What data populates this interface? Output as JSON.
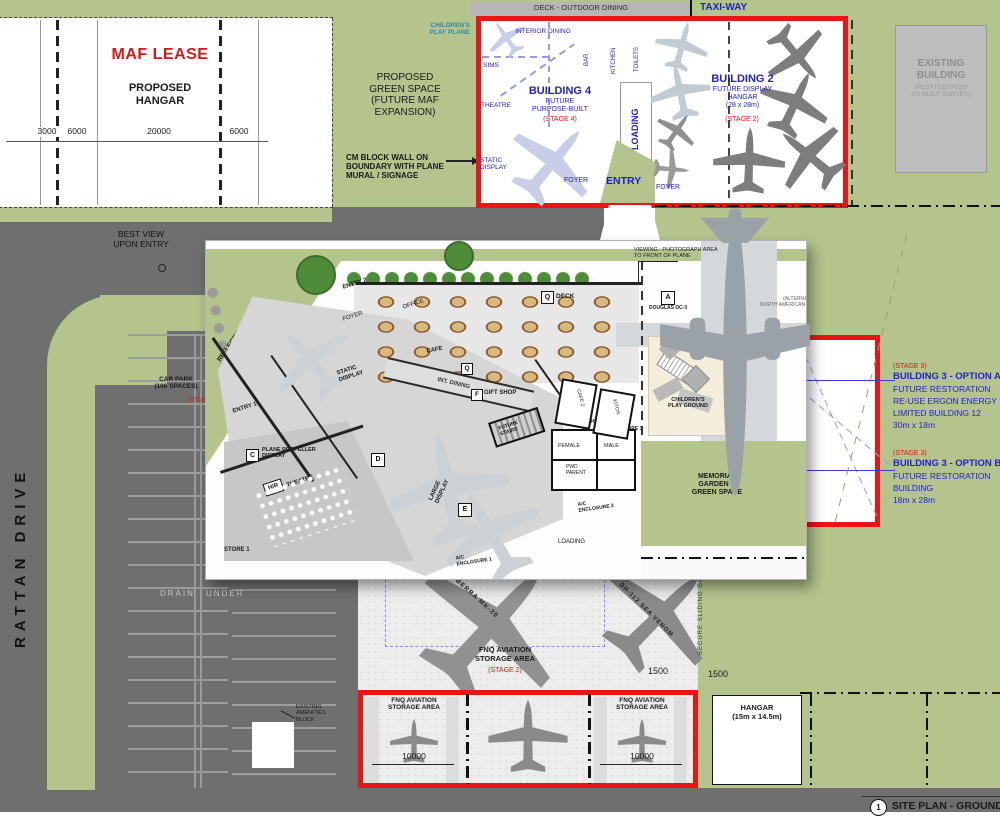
{
  "top": {
    "deck": "DECK - OUTDOOR DINING",
    "taxiway": "TAXI-WAY"
  },
  "maf": {
    "lease": "MAF LEASE",
    "hangar": "PROPOSED\nHANGAR",
    "dims": {
      "d1": "3000",
      "d2": "6000",
      "d3": "20000",
      "d4": "6000"
    }
  },
  "green_space": {
    "label": "PROPOSED\nGREEN SPACE\n(FUTURE MAF\nEXPANSION)",
    "cm_wall": "CM BLOCK WALL ON\nBOUNDARY WITH PLANE\nMURAL / SIGNAGE"
  },
  "b4": {
    "children": "CHILDREN'S\nPLAY PLANE",
    "interior": "INTERIOR DINING",
    "bar": "BAR",
    "kitchen": "KITCHEN",
    "toilets": "TOILETS",
    "sims": "SIMS",
    "theatre": "THEATRE",
    "title": "BUILDING 4",
    "sub": "FUTURE\nPURPOSE-BUILT",
    "stage": "(STAGE 4)",
    "static": "STATIC\nDISPLAY",
    "foyer": "FOYER",
    "loading": "LOADING",
    "entry": "ENTRY"
  },
  "b2": {
    "title": "BUILDING 2",
    "sub": "FUTURE DISPLAY\nHANGAR\n(28 x 28m)",
    "stage": "(STAGE 2)",
    "foyer": "FOYER"
  },
  "existing": {
    "name": "EXISTING\nBUILDING",
    "note": "(PLOTTED FROM\nAS-BUILT SURVEY)"
  },
  "west": {
    "best_view": "BEST VIEW\nUPON ENTRY",
    "street": "RATTAN DRIVE",
    "car_park": "CAR PARK\n(106 SPACES)",
    "car_park_stage": "(STAGE 1)",
    "drain_l": "DRAIN",
    "drain_r": "UNDER"
  },
  "b3": {
    "a_stage": "(STAGE 3)",
    "a_title": "BUILDING 3 - OPTION A:",
    "a_l1": "FUTURE RESTORATION",
    "a_l2": "RE-USE ERGON ENERGY",
    "a_l3": "LIMITED BUILDING 12",
    "a_l4": "30m x 18m",
    "b_stage": "(STAGE 3)",
    "b_title": "BUILDING 3 - OPTION B:",
    "b_l1": "FUTURE RESTORATION",
    "b_l2": "BUILDING",
    "b_l3": "18m x 28m"
  },
  "storage": {
    "label": "FNQ AVIATION\nSTORAGE AREA",
    "stage": "(STAGE 2)",
    "plane1": "CANBERRA  MK-20",
    "plane2": "DH-112 SEA VENOM",
    "dim_a": "1500",
    "dim_b": "1500",
    "gate": "SECURE SLIDING GATE"
  },
  "bays": {
    "label": "FNQ AVIATION\nSTORAGE AREA",
    "dim": "10000"
  },
  "hangar_lot": {
    "label": "HANGAR\n(15m x 14.5m)"
  },
  "amenities": {
    "label": "EXISTING\nAMENITIES\nBLOCK"
  },
  "titleblock": {
    "num": "1",
    "title": "SITE PLAN - GROUND LEVEL"
  },
  "inset": {
    "reflections": "REFLECTIONS\nGARDEN",
    "entry2": "ENTRY 2",
    "foyer": "FOYER",
    "office": "OFFICE",
    "q": "Q",
    "deck": "DECK",
    "cafe": "CAFE",
    "int_dining": "INT. DINING",
    "f": "F",
    "gift": "GIFT SHOP",
    "static": "STATIC\nDISPLAY",
    "entry1": "ENTRY 1",
    "c": "C",
    "prop": "PLANE PROPELLER\nDISPLAY",
    "hr": "H/R",
    "theatre": "THEATRE",
    "store1": "STORE 1",
    "d": "D",
    "e": "E",
    "large": "LARGE\nDISPLAY",
    "stairs": "FUTURE\nSTAIRS",
    "airlock": "AIR LOCK",
    "female": "FEMALE",
    "male": "MALE",
    "pwd": "PWD\nPARENT",
    "ac2": "A/C\nENCLOSURE 2",
    "ac1": "A/C\nENCLOSURE 1",
    "loading": "LOADING",
    "store3": "STORE 3",
    "cafe2": "CAFE 2",
    "kitch": "KITCH.",
    "viewing": "VIEWING : PHOTOGRAPH AREA\nTO FRONT OF PLANE",
    "a": "A",
    "dc3": "DOUGLAS DC-3",
    "alt": "(ALTERNATIVE)\nNORTH AMERICAN B-25 MITCHELL",
    "conc": "CONC. PATHWAY\nACCESS TO PLANE",
    "play": "CHILDREN'S\nPLAY GROUND",
    "memorial": "MEMORIAL\nGARDEN &\nGREEN SPACE"
  }
}
